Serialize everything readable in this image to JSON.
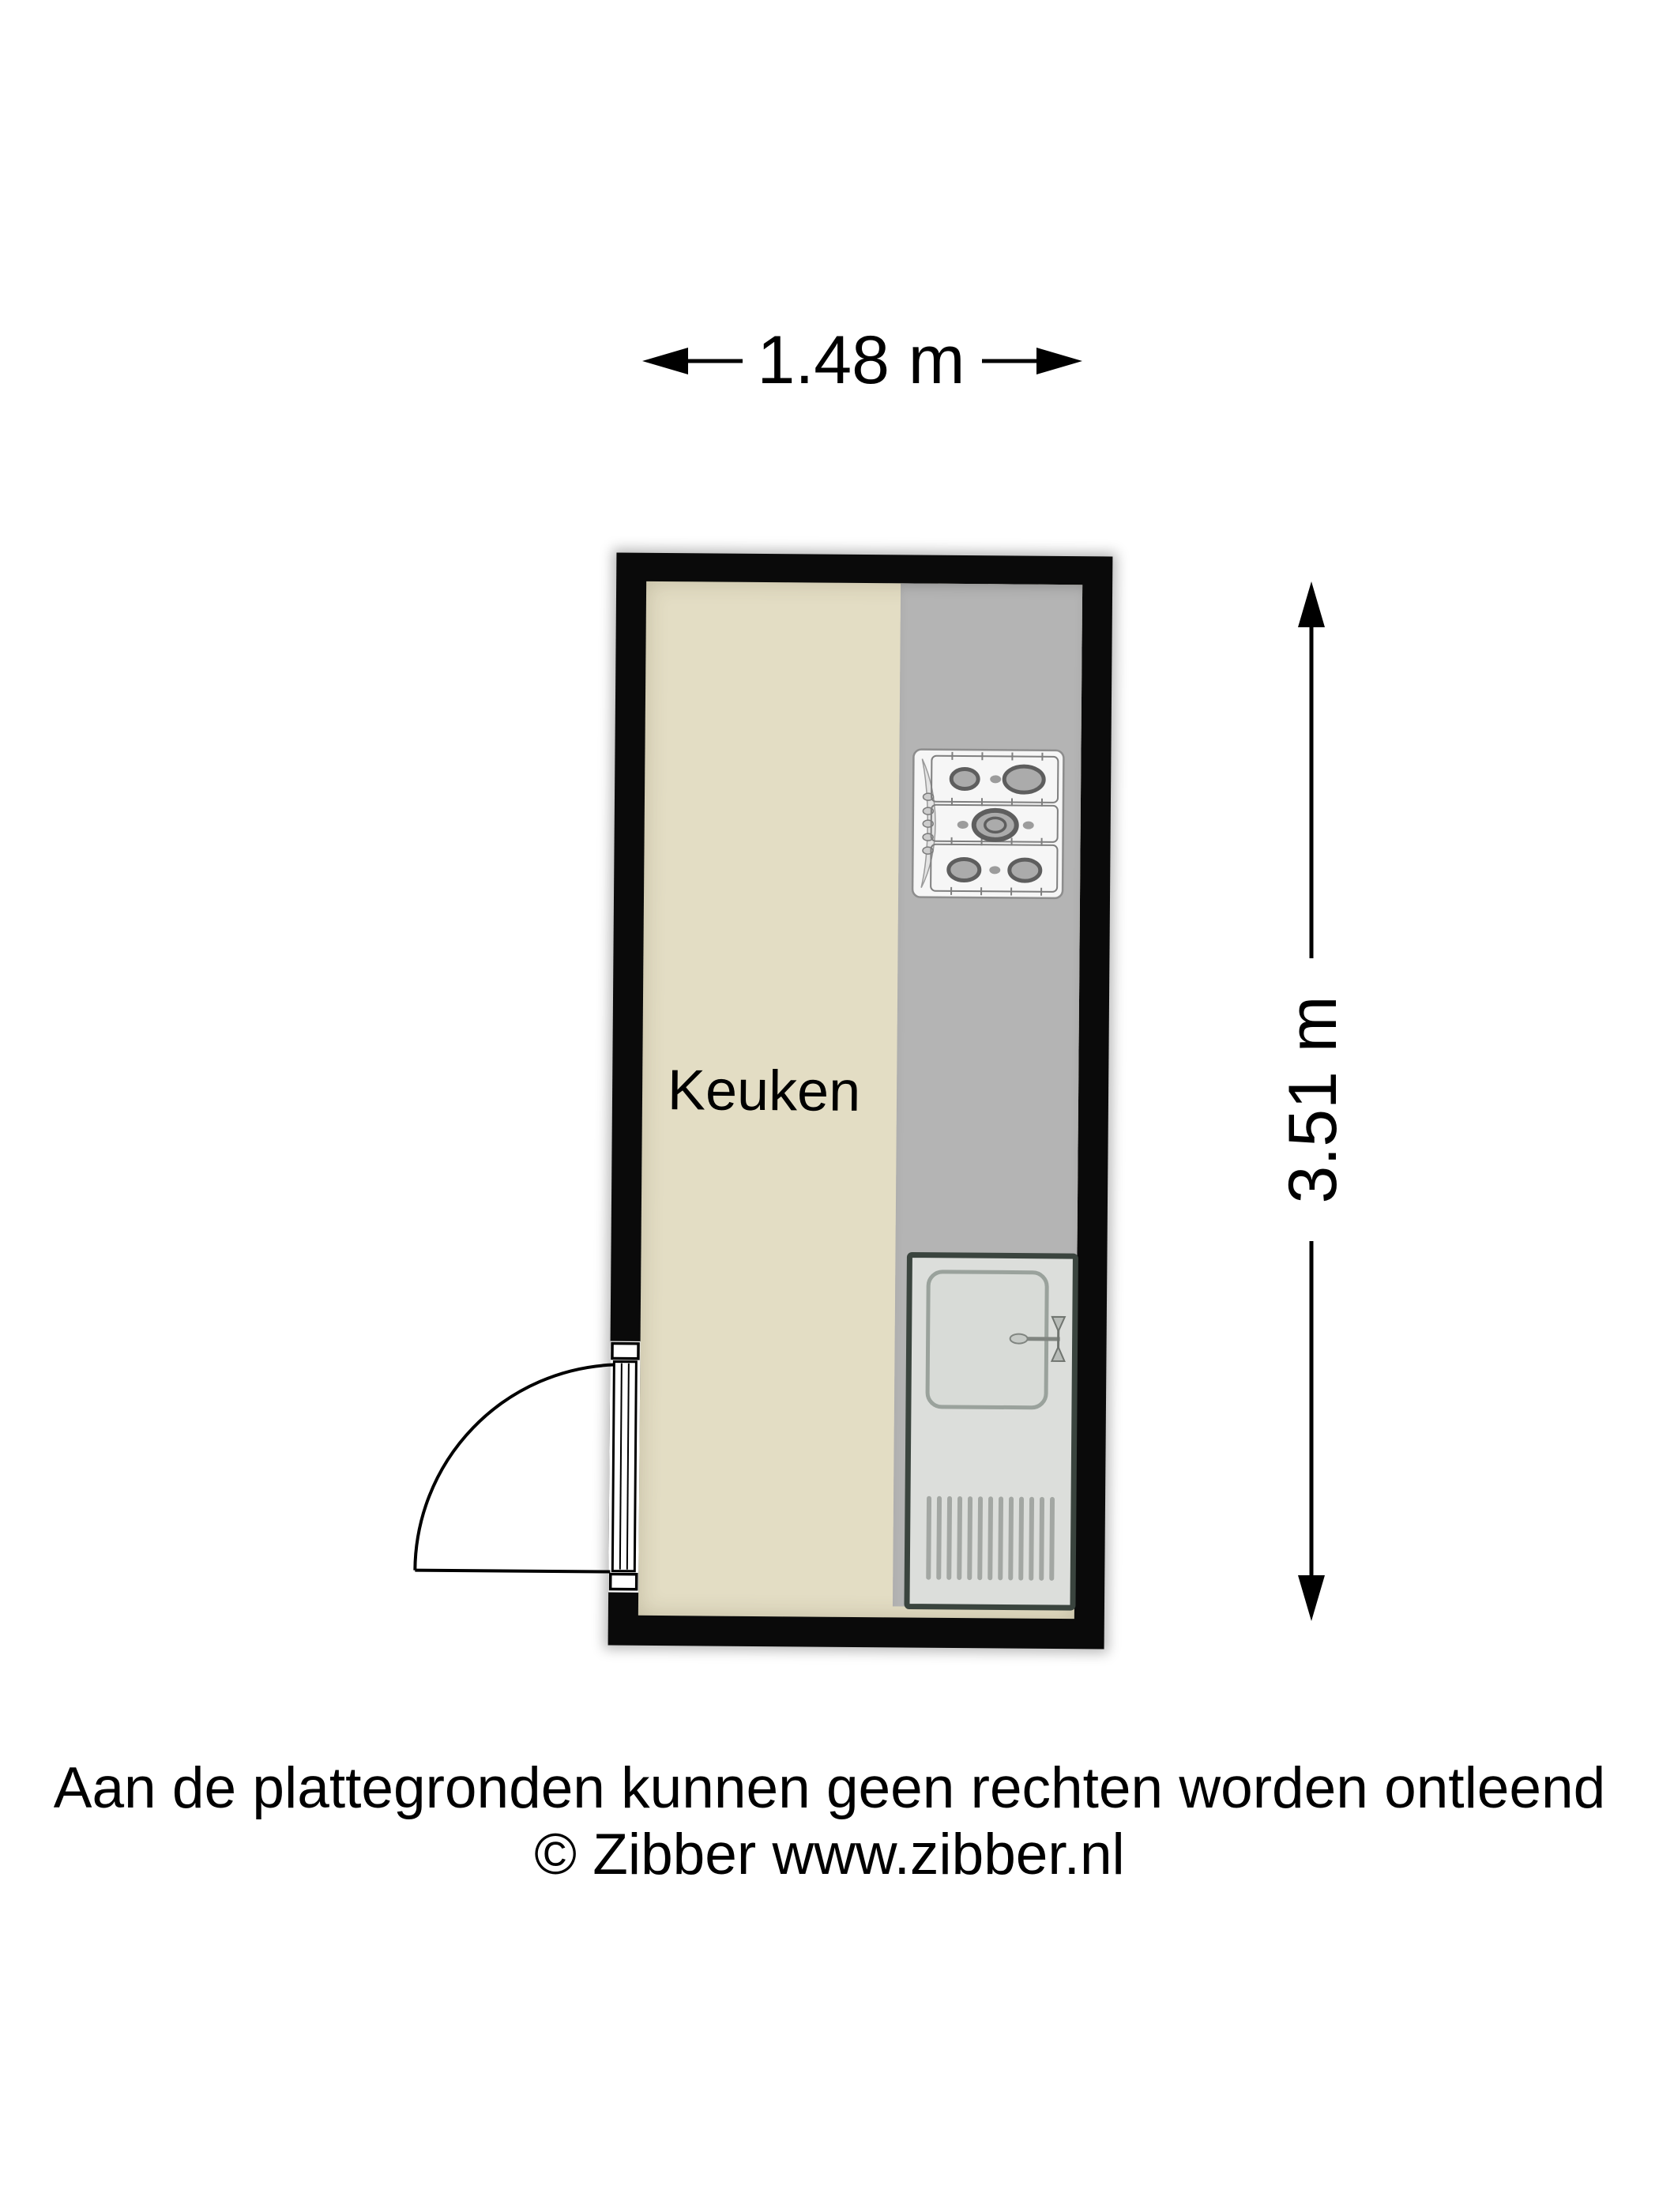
{
  "floorplan": {
    "room": {
      "name": "Keuken"
    },
    "dimensions": {
      "width_label": "1.48 m",
      "height_label": "3.51 m"
    },
    "icons": {
      "stove": "stove-icon",
      "sink": "sink-icon",
      "door": "door-swing-icon"
    }
  },
  "footer": {
    "disclaimer": "Aan de plattegronden kunnen geen rechten worden ontleend",
    "copyright": "© Zibber www.zibber.nl"
  },
  "colors": {
    "wall": "#0a0a0a",
    "floor": "#e3ddc4",
    "counter": "#b4b4b4",
    "sink_border": "#3a443e",
    "sink_face": "#dcdedb",
    "stove_face": "#f6f6f6",
    "dimension_line": "#000000"
  }
}
